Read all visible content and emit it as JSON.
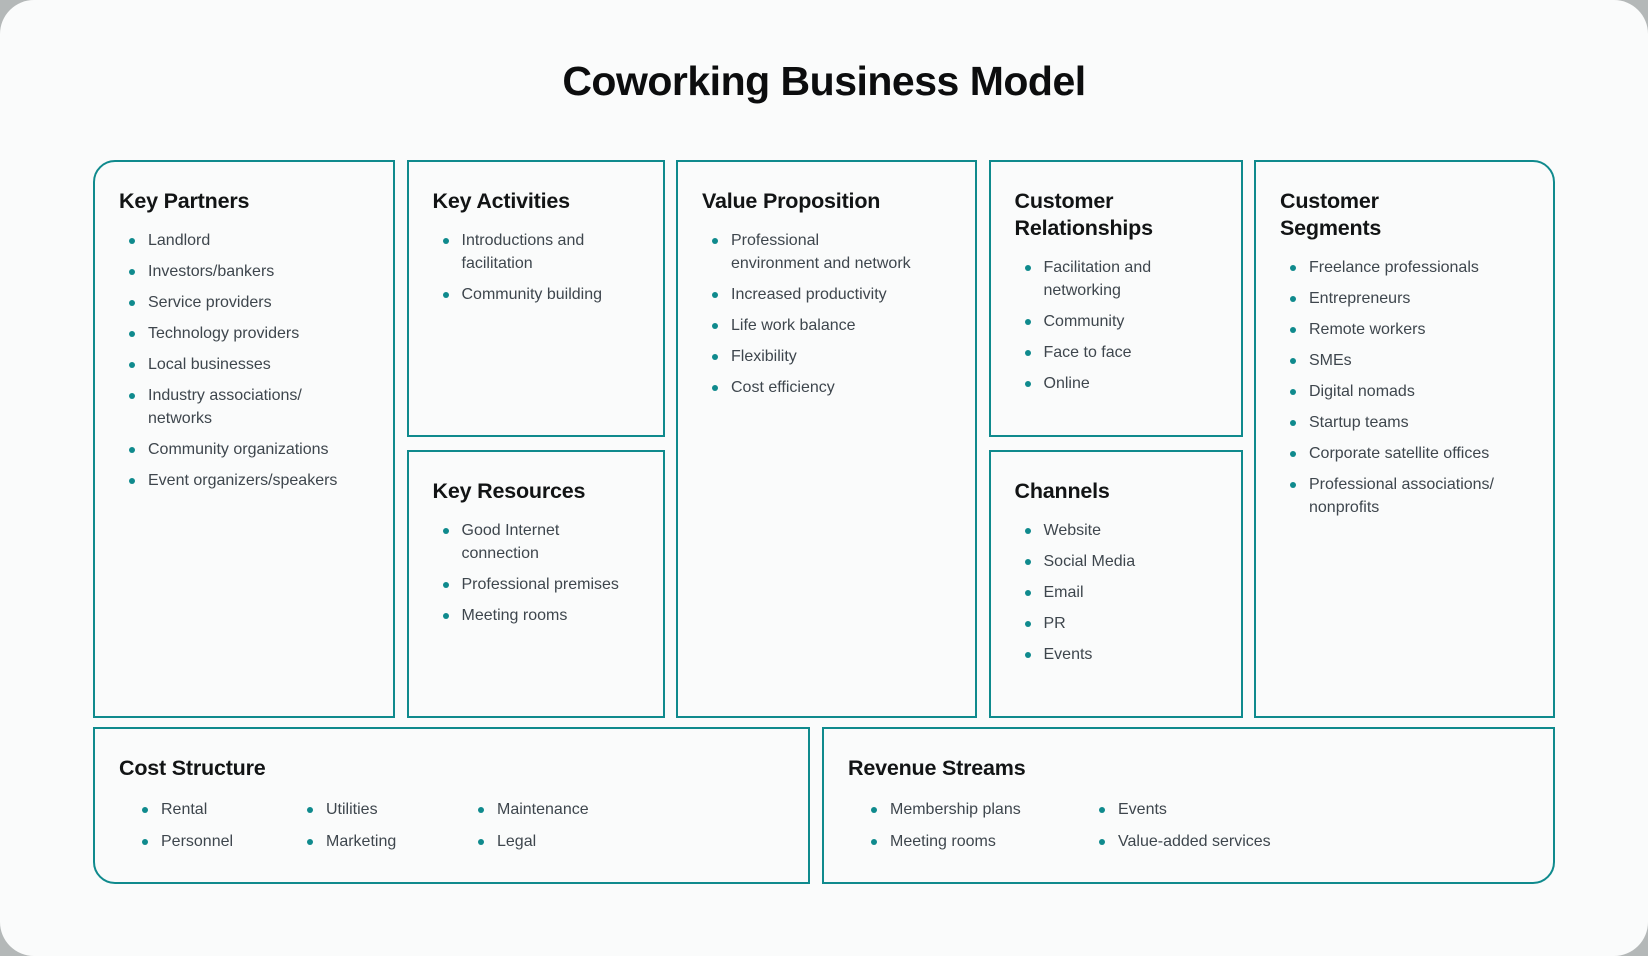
{
  "page": {
    "title": "Coworking Business Model"
  },
  "colors": {
    "accent_teal": "#0f8a8d",
    "heading_text": "#121415",
    "body_text": "#3e464d",
    "card_background": "#fafbfb",
    "outer_background": "#b4b8b8"
  },
  "sections": {
    "key_partners": {
      "title": "Key Partners",
      "items": [
        "Landlord",
        "Investors/bankers",
        "Service providers",
        "Technology providers",
        "Local businesses",
        "Industry associations/\nnetworks",
        "Community organizations",
        "Event organizers/speakers"
      ]
    },
    "key_activities": {
      "title": "Key Activities",
      "items": [
        "Introductions and\nfacilitation",
        "Community building"
      ]
    },
    "key_resources": {
      "title": "Key Resources",
      "items": [
        "Good Internet\nconnection",
        "Professional premises",
        "Meeting rooms"
      ]
    },
    "value_proposition": {
      "title": "Value Proposition",
      "items": [
        "Professional\nenvironment and network",
        "Increased productivity",
        "Life work balance",
        "Flexibility",
        "Cost efficiency"
      ]
    },
    "customer_relationships": {
      "title": "Customer\nRelationships",
      "items": [
        "Facilitation and\nnetworking",
        "Community",
        "Face to face",
        "Online"
      ]
    },
    "channels": {
      "title": "Channels",
      "items": [
        "Website",
        "Social Media",
        "Email",
        "PR",
        "Events"
      ]
    },
    "customer_segments": {
      "title": "Customer\nSegments",
      "items": [
        "Freelance professionals",
        "Entrepreneurs",
        "Remote workers",
        "SMEs",
        "Digital nomads",
        "Startup teams",
        "Corporate satellite offices",
        "Professional associations/\nnonprofits"
      ]
    },
    "cost_structure": {
      "title": "Cost Structure",
      "columns": [
        [
          "Rental",
          "Personnel"
        ],
        [
          "Utilities",
          "Marketing"
        ],
        [
          "Maintenance",
          "Legal"
        ]
      ]
    },
    "revenue_streams": {
      "title": "Revenue Streams",
      "columns": [
        [
          "Membership plans",
          "Meeting rooms"
        ],
        [
          "Events",
          "Value-added services"
        ]
      ]
    }
  }
}
